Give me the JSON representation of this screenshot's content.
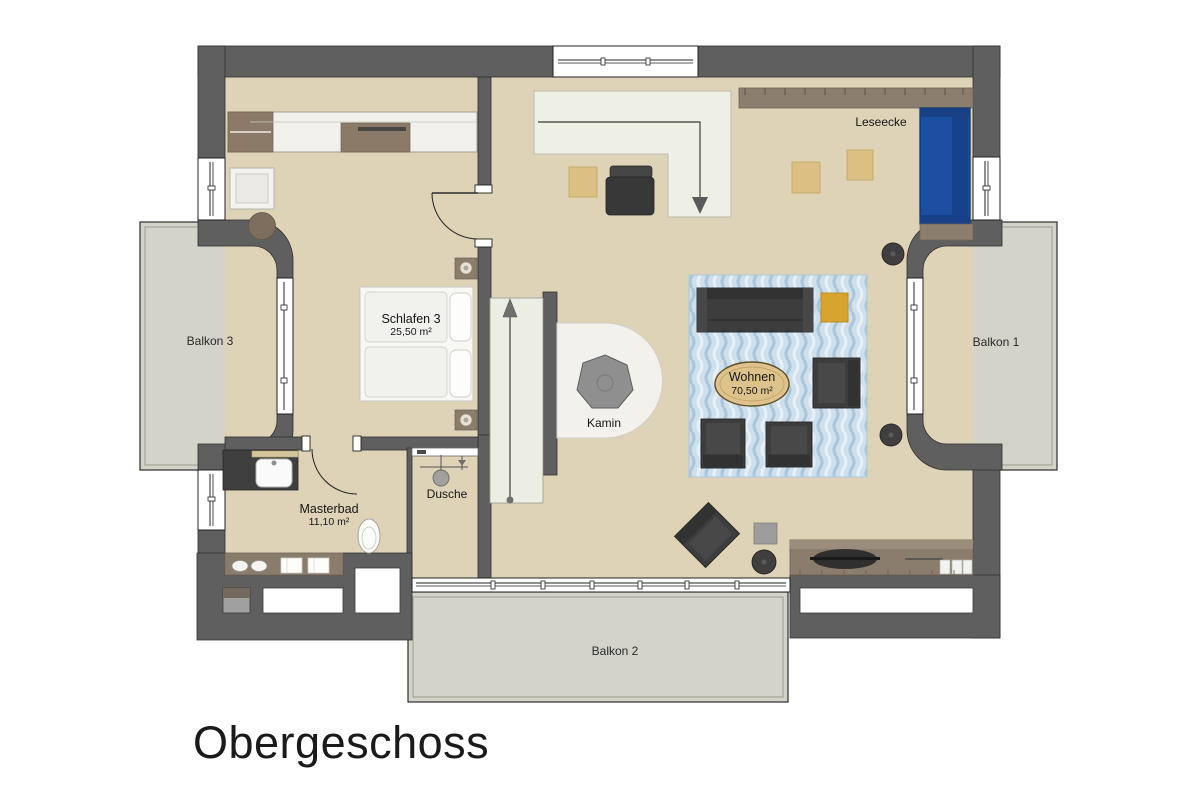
{
  "meta": {
    "title": "Obergeschoss"
  },
  "rooms": {
    "schlafen3": {
      "name": "Schlafen 3",
      "area": "25,50 m²"
    },
    "masterbad": {
      "name": "Masterbad",
      "area": "11,10 m²"
    },
    "wohnen": {
      "name": "Wohnen",
      "area": "70,50 m²"
    },
    "dusche": {
      "name": "Dusche"
    },
    "leseecke": {
      "name": "Leseecke"
    },
    "kamin": {
      "name": "Kamin"
    },
    "balkon1": {
      "name": "Balkon 1"
    },
    "balkon2": {
      "name": "Balkon 2"
    },
    "balkon3": {
      "name": "Balkon 3"
    }
  },
  "colors": {
    "wall": "#5f5f5f",
    "floor": "#ded3b6",
    "balcony": "#d3d3ca",
    "stairs": "#eceee3",
    "void_area": "#eef0e6",
    "rug_blue": "#cfe0ec",
    "sofa_blue": "#1c4fa0",
    "accent_yellow": "#d7a52e",
    "furniture_dark": "#3d3d3d",
    "wood_brown": "#8a7d6d"
  }
}
